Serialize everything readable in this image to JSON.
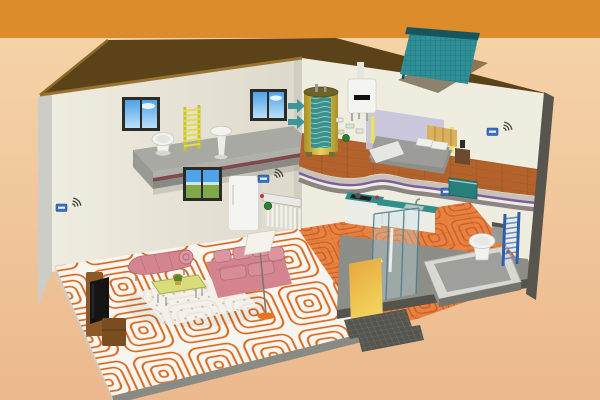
{
  "meta": {
    "title": "Cutaway illustration of a two-storey house underfloor heating system",
    "canvas": {
      "width": 600,
      "height": 400
    },
    "visible_text": []
  },
  "colors": {
    "bg_top": "#DD8C2B",
    "bg_main": "#F5D3A7",
    "bg_main_deep": "#EBB98D",
    "roof": "#5C4218",
    "roof_edge_light": "#8A6826",
    "roof_eave": "#997431",
    "roof_shadow": "#3A2B0E",
    "wall": "#DDD9CB",
    "wall_light": "#EFECE0",
    "wall_edge": "#CDCDC7",
    "wall_edge_right": "#57554E",
    "slab_top": "#A9A9A3",
    "slab_lip": "#B0B0AA",
    "slab_stripe": "#7E4A50",
    "slab_edge": "#8A8A84",
    "concrete": "#8E8E88",
    "concrete_dark": "#55534E",
    "floor_white": "#F7F5EF",
    "coil_orange": "#D96A1F",
    "coil_red": "#B03A28",
    "tile_orange": "#E8823D",
    "tile_line": "#C96A2A",
    "wood": "#B2622A",
    "wood_line": "#8F4C1E",
    "purple_stripe": "#7B5FA0",
    "solar_teal": "#2E8F96",
    "solar_dark": "#16555E",
    "tank_shell": "#D8C24A",
    "tank_dark": "#A89028",
    "tank_hi": "#E8D45E",
    "tank_core": "#3E8F8A",
    "boiler_white": "#F4F4F0",
    "thermostat_blue": "#3A6FC4",
    "radiator_yellow": "#C8C22E",
    "radiator_yellow_rung": "#E2DC48",
    "radiator_blue_rail": "#2E5FA8",
    "radiator_blue_rung": "#5F8FD8",
    "counter_teal": "#2E8F8C",
    "cabinet_white": "#EDEDE8",
    "halfwall_orange": "#E8A53A",
    "halfwall_yellow": "#F2D560",
    "glass_blue": "#BFE0E8",
    "pink_sofa": "#D4848E",
    "pink_light": "#DC95A0",
    "pink_dark": "#B06A74",
    "table_top": "#D8DC7A",
    "rug_white": "#F4F2EC",
    "lamp_base": "#E8731F",
    "tv_brown": "#8A5A28",
    "tv_brown_dark": "#7A4E20",
    "tv_screen": "#141414",
    "bed_gray": "#9C9C98",
    "bed_base": "#8F8F8A",
    "bed_white": "#E6E6E2",
    "headboard": "#D9B05C",
    "panel_lavender": "#C7C3DC",
    "lamp_bar_yellow": "#EDE35A",
    "sky": "#4FA3E8",
    "sky_light": "#BBDFF8",
    "landscape_green": "#7FA848",
    "fixture_white": "#F2F2EE",
    "fixture_shadow": "#C8C8C2",
    "metal_gray": "#9A9A94",
    "green_pump": "#2E7D32",
    "mat_dark": "#55554F",
    "tub_outer": "#D9D9D4",
    "tub_inner": "#9FA09B",
    "tub_front": "#74736C"
  },
  "components": [
    {
      "id": "solar-collector",
      "kind": "rooftop solar thermal collector"
    },
    {
      "id": "roof",
      "kind": "hip roof"
    },
    {
      "id": "boiler",
      "kind": "wall-hung boiler"
    },
    {
      "id": "water-tank",
      "kind": "hot water storage tank (cutaway)"
    },
    {
      "id": "heating-manifold",
      "kind": "underfloor heating manifold"
    },
    {
      "id": "heating-coils-living",
      "kind": "underfloor heating pipe coils"
    },
    {
      "id": "heating-coils-kitchen",
      "kind": "underfloor heating pipe coils"
    },
    {
      "id": "thermostat",
      "kind": "wireless room thermostat",
      "count": 4
    },
    {
      "id": "towel-radiator-yellow",
      "kind": "ladder towel radiator upstairs"
    },
    {
      "id": "towel-radiator-blue",
      "kind": "ladder towel radiator downstairs"
    },
    {
      "id": "toilet-upstairs",
      "kind": "toilet"
    },
    {
      "id": "pedestal-sink",
      "kind": "pedestal wash basin"
    },
    {
      "id": "toilet-downstairs",
      "kind": "toilet"
    },
    {
      "id": "bathtub",
      "kind": "bathtub"
    },
    {
      "id": "shower-enclosure",
      "kind": "glass shower"
    },
    {
      "id": "kitchen-counter",
      "kind": "L-shaped kitchen counter"
    },
    {
      "id": "fridge",
      "kind": "refrigerator"
    },
    {
      "id": "bed",
      "kind": "double bed"
    },
    {
      "id": "sofa",
      "kind": "pink sofa"
    },
    {
      "id": "chaise-longue",
      "kind": "pink chaise"
    },
    {
      "id": "coffee-table",
      "kind": "coffee table with rug"
    },
    {
      "id": "floor-lamp",
      "kind": "floor lamp"
    },
    {
      "id": "tv-stand",
      "kind": "TV cabinet with television"
    },
    {
      "id": "window",
      "kind": "window with sky view",
      "count": 2
    },
    {
      "id": "landscape-window",
      "kind": "ground floor window"
    },
    {
      "id": "floor-mats",
      "kind": "entry mats / steps"
    }
  ]
}
